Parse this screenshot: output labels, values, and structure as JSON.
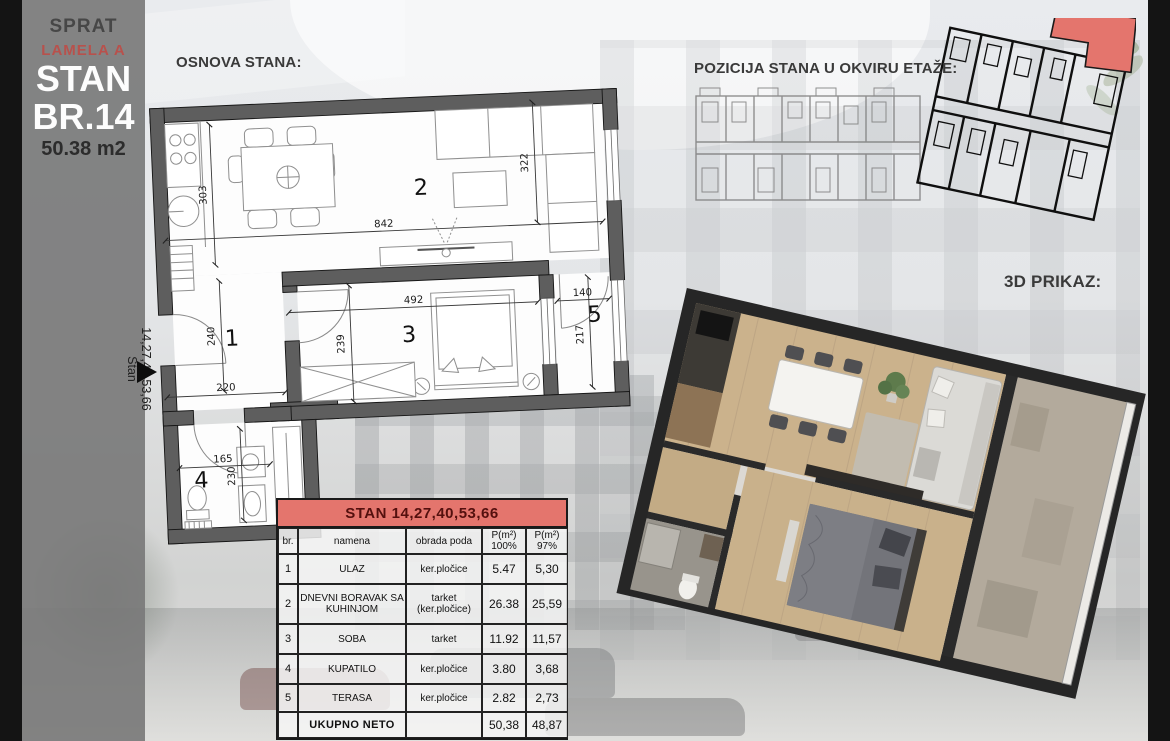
{
  "sidebar": {
    "floor": "SPRAT",
    "lamela": "LAMELA A",
    "stan": "STAN",
    "number": "BR.14",
    "area": "50.38 m2",
    "vertical_line1": "Stan",
    "vertical_line2": "14,27,40,53,66"
  },
  "floor_plan": {
    "title": "OSNOVA STANA:",
    "rooms": {
      "r1": "1",
      "r2": "2",
      "r3": "3",
      "r4": "4",
      "r5": "5"
    },
    "dims": {
      "d303": "303",
      "d842": "842",
      "d322": "322",
      "d240": "240",
      "d220": "220",
      "d239": "239",
      "d492": "492",
      "d140": "140",
      "d217": "217",
      "d165": "165",
      "d230": "230"
    }
  },
  "etage": {
    "title": "POZICIJA STANA U OKVIRU ETAŽE:"
  },
  "render3d": {
    "title": "3D PRIKAZ:"
  },
  "table": {
    "title": "STAN  14,27,40,53,66",
    "headers": {
      "br": "br.",
      "namena": "namena",
      "obrada": "obrada poda",
      "p100_top": "P(m²)",
      "p100_bot": "100%",
      "p97_top": "P(m²)",
      "p97_bot": "97%"
    },
    "rows": [
      [
        "1",
        "ULAZ",
        "ker.pločice",
        "5.47",
        "5,30"
      ],
      [
        "2",
        "DNEVNI BORAVAK SA KUHINJOM",
        "tarket (ker.pločice)",
        "26.38",
        "25,59"
      ],
      [
        "3",
        "SOBA",
        "tarket",
        "11.92",
        "11,57"
      ],
      [
        "4",
        "KUPATILO",
        "ker.pločice",
        "3.80",
        "3,68"
      ],
      [
        "5",
        "TERASA",
        "ker.pločice",
        "2.82",
        "2,73"
      ]
    ],
    "total": {
      "label": "UKUPNO NETO",
      "p100": "50,38",
      "p97": "48,87"
    }
  },
  "colors": {
    "accent_red": "#e4756d",
    "wall_gray": "#5e5e5e",
    "sidebar_gray": "#7a7a7a",
    "frame_black": "#141414"
  }
}
